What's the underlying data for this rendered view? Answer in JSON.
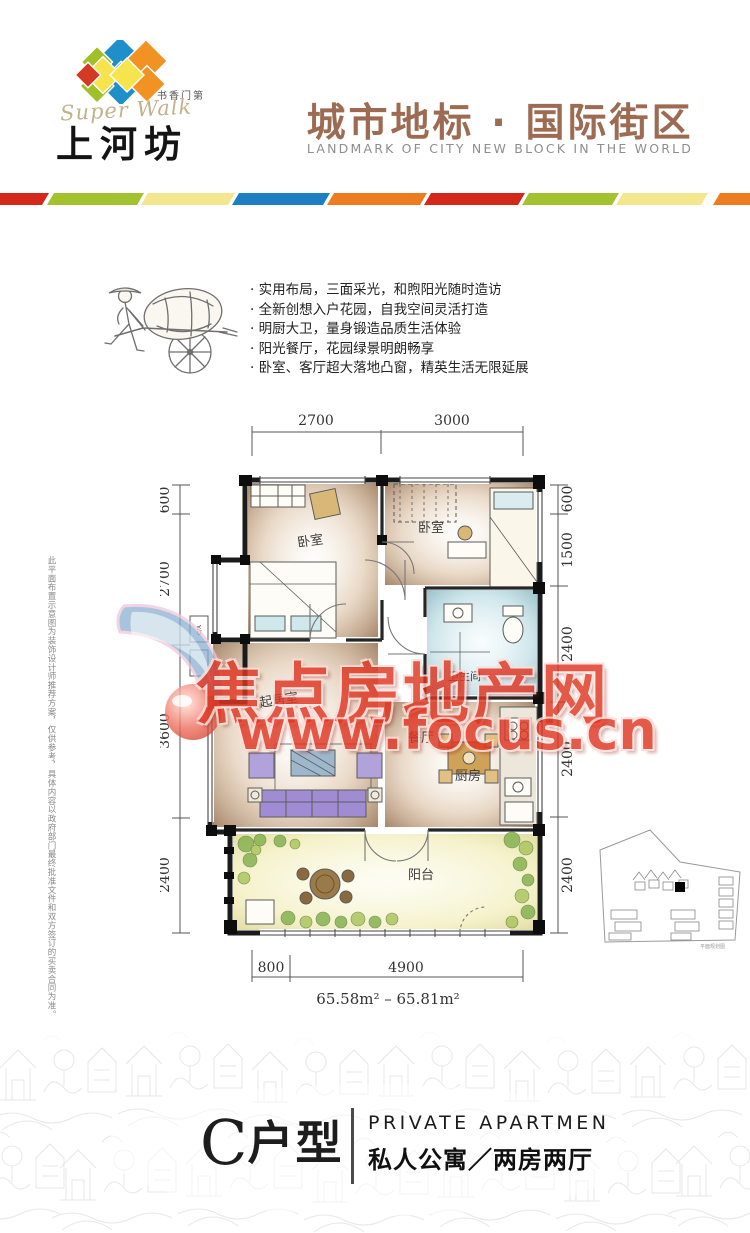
{
  "header": {
    "sub_brand": "书香门第",
    "script_name": "Super Walk",
    "brand_name": "上河坊",
    "slogan_cn": "城市地标 · 国际街区",
    "slogan_en": "LANDMARK OF CITY NEW BLOCK IN THE WORLD",
    "stripe_colors": [
      "#d5281c",
      "#a3c22f",
      "#f3e68e",
      "#1d7fc1",
      "#ec7c1f",
      "#d5281c",
      "#a3c22f",
      "#f3e68e",
      "#ec7c1f"
    ]
  },
  "features": {
    "items": [
      "实用布局，三面采光，和煦阳光随时造访",
      "全新创想入户花园，自我空间灵活打造",
      "明厨大卫，量身锻造品质生活体验",
      "阳光餐厅，花园绿景明朗畅享",
      "卧室、客厅超大落地凸窗，精英生活无限延展"
    ]
  },
  "floor_plan": {
    "dims_top": [
      "2700",
      "3000"
    ],
    "dims_left": [
      "600",
      "2700",
      "3600",
      "2400"
    ],
    "dims_right": [
      "600",
      "1500",
      "2400",
      "2400",
      "2400"
    ],
    "dims_bottom": [
      "800",
      "4900"
    ],
    "area_range": "65.58m² – 65.81m²",
    "rooms": {
      "bedroom_left": "卧室",
      "bedroom_right": "卧室",
      "living": "起居室",
      "dining": "餐厅",
      "kitchen": "厨房",
      "bathroom": "卫生间",
      "balcony": "阳台",
      "ac_label": "C/A"
    },
    "site_plan_caption": "平面规划图"
  },
  "watermark": {
    "site_name": "焦点房地产网",
    "site_url": "www.focus.cn",
    "color": "#e03522"
  },
  "disclaimer": "此平面布置示意图为装饰设计师推荐方案，仅供参考，具体内容以政府部门最终批准文件和双方签订的买卖合同为准。",
  "footer": {
    "unit_letter": "C",
    "unit_suffix": "户型",
    "type_en": "PRIVATE  APARTMEN",
    "type_cn": "私人公寓／两房两厅"
  }
}
